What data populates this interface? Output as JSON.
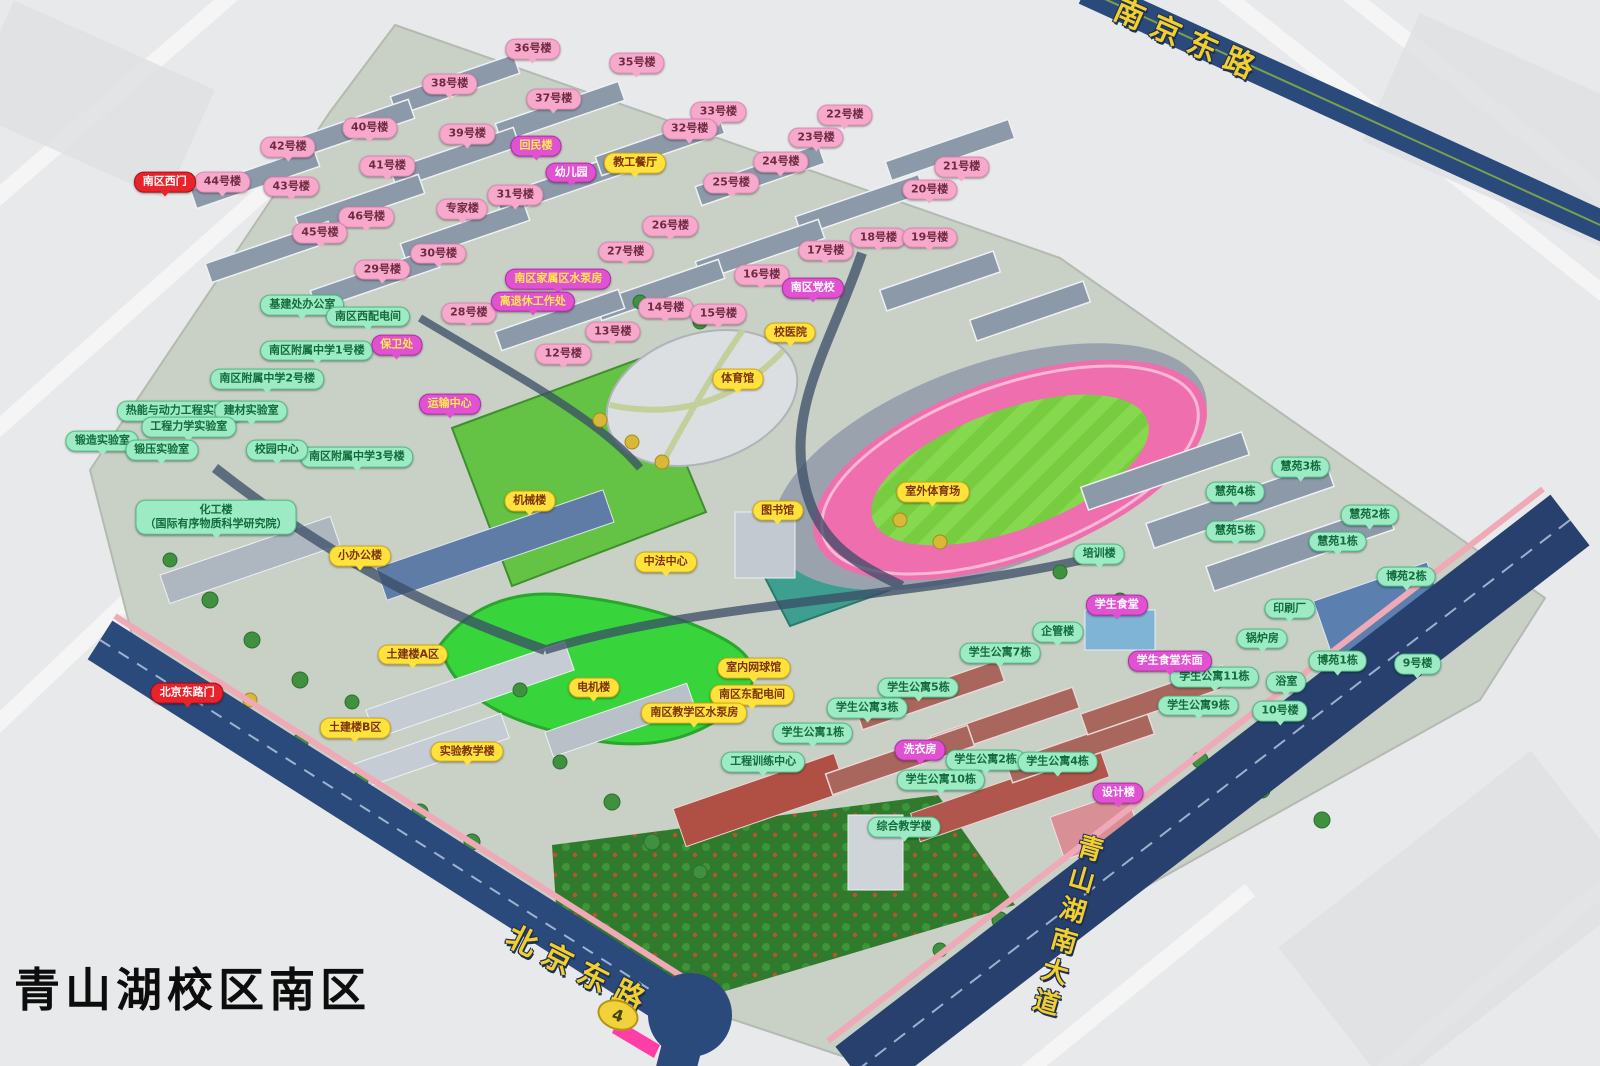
{
  "title": "青山湖校区南区",
  "route_badge": "4",
  "road_labels": [
    {
      "text": "南京东路",
      "x": 74.4,
      "y": 3.6,
      "rotate": 24,
      "vertical": false
    },
    {
      "text": "北京东路",
      "x": 36.3,
      "y": 90.8,
      "rotate": 27,
      "vertical": false
    },
    {
      "text": "青山湖南大道",
      "x": 66.6,
      "y": 87.0,
      "rotate": 16,
      "vertical": true
    }
  ],
  "colors": {
    "building_label_pink": "#F6A9CB",
    "facility_label_yellow": "#FFE23C",
    "facility_label_green": "#9CEBC4",
    "facility_label_magenta": "#E052D2",
    "gate_label_red": "#E8232B",
    "road": "#2B4A7C",
    "stadium_track": "#EF6FAE",
    "field_green": "#7FD84A"
  },
  "labels": [
    {
      "text": "36号楼",
      "x": 33.3,
      "y": 4.6,
      "type": "pink"
    },
    {
      "text": "35号楼",
      "x": 39.8,
      "y": 5.9,
      "type": "pink"
    },
    {
      "text": "38号楼",
      "x": 28.1,
      "y": 7.9,
      "type": "pink"
    },
    {
      "text": "37号楼",
      "x": 34.6,
      "y": 9.3,
      "type": "pink"
    },
    {
      "text": "33号楼",
      "x": 44.9,
      "y": 10.5,
      "type": "pink"
    },
    {
      "text": "32号楼",
      "x": 43.1,
      "y": 12.1,
      "type": "pink"
    },
    {
      "text": "22号楼",
      "x": 52.8,
      "y": 10.8,
      "type": "pink"
    },
    {
      "text": "23号楼",
      "x": 51.0,
      "y": 12.9,
      "type": "pink"
    },
    {
      "text": "40号楼",
      "x": 23.1,
      "y": 12.0,
      "type": "pink"
    },
    {
      "text": "39号楼",
      "x": 29.2,
      "y": 12.6,
      "type": "pink"
    },
    {
      "text": "42号楼",
      "x": 18.0,
      "y": 13.8,
      "type": "pink"
    },
    {
      "text": "41号楼",
      "x": 24.2,
      "y": 15.6,
      "type": "pink"
    },
    {
      "text": "44号楼",
      "x": 13.9,
      "y": 17.1,
      "type": "pink"
    },
    {
      "text": "43号楼",
      "x": 18.2,
      "y": 17.5,
      "type": "pink"
    },
    {
      "text": "24号楼",
      "x": 48.8,
      "y": 15.2,
      "type": "pink"
    },
    {
      "text": "25号楼",
      "x": 45.7,
      "y": 17.2,
      "type": "pink"
    },
    {
      "text": "21号楼",
      "x": 60.1,
      "y": 15.7,
      "type": "pink"
    },
    {
      "text": "20号楼",
      "x": 58.1,
      "y": 17.8,
      "type": "pink"
    },
    {
      "text": "31号楼",
      "x": 32.2,
      "y": 18.3,
      "type": "pink"
    },
    {
      "text": "专家楼",
      "x": 28.9,
      "y": 19.6,
      "type": "pink"
    },
    {
      "text": "46号楼",
      "x": 22.9,
      "y": 20.4,
      "type": "pink"
    },
    {
      "text": "45号楼",
      "x": 20.0,
      "y": 21.9,
      "type": "pink"
    },
    {
      "text": "26号楼",
      "x": 41.9,
      "y": 21.2,
      "type": "pink"
    },
    {
      "text": "27号楼",
      "x": 39.1,
      "y": 23.6,
      "type": "pink"
    },
    {
      "text": "17号楼",
      "x": 51.6,
      "y": 23.5,
      "type": "pink"
    },
    {
      "text": "18号楼",
      "x": 54.9,
      "y": 22.3,
      "type": "pink"
    },
    {
      "text": "19号楼",
      "x": 58.1,
      "y": 22.3,
      "type": "pink"
    },
    {
      "text": "30号楼",
      "x": 27.4,
      "y": 23.8,
      "type": "pink"
    },
    {
      "text": "29号楼",
      "x": 23.9,
      "y": 25.3,
      "type": "pink"
    },
    {
      "text": "28号楼",
      "x": 29.3,
      "y": 29.4,
      "type": "pink"
    },
    {
      "text": "16号楼",
      "x": 47.6,
      "y": 25.8,
      "type": "pink"
    },
    {
      "text": "14号楼",
      "x": 41.6,
      "y": 28.9,
      "type": "pink"
    },
    {
      "text": "15号楼",
      "x": 44.9,
      "y": 29.5,
      "type": "pink"
    },
    {
      "text": "13号楼",
      "x": 38.3,
      "y": 31.1,
      "type": "pink"
    },
    {
      "text": "12号楼",
      "x": 35.2,
      "y": 33.2,
      "type": "pink"
    },
    {
      "text": "教工餐厅",
      "x": 39.7,
      "y": 15.3,
      "type": "yellow"
    },
    {
      "text": "校医院",
      "x": 49.4,
      "y": 31.2,
      "type": "yellow"
    },
    {
      "text": "体育馆",
      "x": 46.1,
      "y": 35.6,
      "type": "yellow"
    },
    {
      "text": "室外体育场",
      "x": 58.3,
      "y": 46.2,
      "type": "yellow"
    },
    {
      "text": "机械楼",
      "x": 33.1,
      "y": 47.0,
      "type": "yellow"
    },
    {
      "text": "图书馆",
      "x": 48.6,
      "y": 47.9,
      "type": "yellow"
    },
    {
      "text": "中法中心",
      "x": 41.6,
      "y": 52.7,
      "type": "yellow"
    },
    {
      "text": "小办公楼",
      "x": 22.5,
      "y": 52.2,
      "type": "yellow"
    },
    {
      "text": "土建楼A区",
      "x": 25.8,
      "y": 61.4,
      "type": "yellow"
    },
    {
      "text": "土建楼B区",
      "x": 22.2,
      "y": 68.3,
      "type": "yellow"
    },
    {
      "text": "电机楼",
      "x": 37.1,
      "y": 64.5,
      "type": "yellow"
    },
    {
      "text": "实验教学楼",
      "x": 29.2,
      "y": 70.5,
      "type": "yellow"
    },
    {
      "text": "室内网球馆",
      "x": 47.1,
      "y": 62.7,
      "type": "yellow"
    },
    {
      "text": "南区东配电间",
      "x": 47.0,
      "y": 65.2,
      "type": "yellow"
    },
    {
      "text": "南区教学区水泵房",
      "x": 43.4,
      "y": 66.9,
      "type": "yellow"
    },
    {
      "text": "基建处办公室",
      "x": 18.9,
      "y": 28.6,
      "type": "green"
    },
    {
      "text": "南区西配电间",
      "x": 23.0,
      "y": 29.7,
      "type": "green"
    },
    {
      "text": "南区附属中学1号楼",
      "x": 19.8,
      "y": 32.9,
      "type": "green"
    },
    {
      "text": "南区附属中学2号楼",
      "x": 16.7,
      "y": 35.6,
      "type": "green"
    },
    {
      "text": "南区附属中学3号楼",
      "x": 22.3,
      "y": 42.9,
      "type": "green"
    },
    {
      "text": "热能与动力工程实验室",
      "x": 11.3,
      "y": 38.6,
      "type": "green"
    },
    {
      "text": "建材实验室",
      "x": 15.7,
      "y": 38.6,
      "type": "green"
    },
    {
      "text": "工程力学实验室",
      "x": 11.8,
      "y": 40.1,
      "type": "green"
    },
    {
      "text": "锻造实验室",
      "x": 6.4,
      "y": 41.4,
      "type": "green"
    },
    {
      "text": "锻压实验室",
      "x": 10.1,
      "y": 42.2,
      "type": "green"
    },
    {
      "text": "校园中心",
      "x": 17.3,
      "y": 42.2,
      "type": "green"
    },
    {
      "text": "化工楼\n（国际有序物质科学研究院）",
      "x": 13.5,
      "y": 48.5,
      "type": "green"
    },
    {
      "text": "慧苑3栋",
      "x": 81.3,
      "y": 43.8,
      "type": "green"
    },
    {
      "text": "慧苑4栋",
      "x": 77.2,
      "y": 46.2,
      "type": "green"
    },
    {
      "text": "慧苑2栋",
      "x": 85.6,
      "y": 48.3,
      "type": "green"
    },
    {
      "text": "慧苑5栋",
      "x": 77.2,
      "y": 49.8,
      "type": "green"
    },
    {
      "text": "慧苑1栋",
      "x": 83.6,
      "y": 50.8,
      "type": "green"
    },
    {
      "text": "博苑2栋",
      "x": 87.9,
      "y": 54.1,
      "type": "green"
    },
    {
      "text": "博苑1栋",
      "x": 83.6,
      "y": 62.0,
      "type": "green"
    },
    {
      "text": "培训楼",
      "x": 68.7,
      "y": 52.0,
      "type": "green"
    },
    {
      "text": "企管楼",
      "x": 66.1,
      "y": 59.3,
      "type": "green"
    },
    {
      "text": "印刷厂",
      "x": 80.6,
      "y": 57.1,
      "type": "green"
    },
    {
      "text": "锅炉房",
      "x": 78.9,
      "y": 59.9,
      "type": "green"
    },
    {
      "text": "9号楼",
      "x": 88.6,
      "y": 62.3,
      "type": "green"
    },
    {
      "text": "10号楼",
      "x": 80.0,
      "y": 66.7,
      "type": "green"
    },
    {
      "text": "浴室",
      "x": 80.4,
      "y": 64.0,
      "type": "green"
    },
    {
      "text": "学生公寓11栋",
      "x": 75.9,
      "y": 63.5,
      "type": "green"
    },
    {
      "text": "学生公寓9栋",
      "x": 74.9,
      "y": 66.2,
      "type": "green"
    },
    {
      "text": "学生公寓7栋",
      "x": 62.5,
      "y": 61.3,
      "type": "green"
    },
    {
      "text": "学生公寓5栋",
      "x": 57.4,
      "y": 64.5,
      "type": "green"
    },
    {
      "text": "学生公寓3栋",
      "x": 54.2,
      "y": 66.4,
      "type": "green"
    },
    {
      "text": "学生公寓1栋",
      "x": 50.8,
      "y": 68.8,
      "type": "green"
    },
    {
      "text": "学生公寓2栋",
      "x": 61.6,
      "y": 71.3,
      "type": "green"
    },
    {
      "text": "学生公寓4栋",
      "x": 66.1,
      "y": 71.5,
      "type": "green"
    },
    {
      "text": "学生公寓10栋",
      "x": 58.8,
      "y": 73.2,
      "type": "green"
    },
    {
      "text": "工程训练中心",
      "x": 47.7,
      "y": 71.5,
      "type": "green"
    },
    {
      "text": "综合教学楼",
      "x": 56.5,
      "y": 77.6,
      "type": "green"
    },
    {
      "text": "幼儿园",
      "x": 35.7,
      "y": 16.2,
      "type": "magenta"
    },
    {
      "text": "南区党校",
      "x": 50.8,
      "y": 27.0,
      "type": "magenta"
    },
    {
      "text": "学生食堂",
      "x": 69.8,
      "y": 56.8,
      "type": "magenta"
    },
    {
      "text": "学生食堂东面",
      "x": 73.1,
      "y": 62.0,
      "type": "magenta"
    },
    {
      "text": "洗衣房",
      "x": 57.5,
      "y": 70.4,
      "type": "magenta"
    },
    {
      "text": "设计楼",
      "x": 69.9,
      "y": 74.4,
      "type": "magenta"
    },
    {
      "text": "回民楼",
      "x": 33.5,
      "y": 13.7,
      "type": "magentaY"
    },
    {
      "text": "南区家属区水泵房",
      "x": 34.9,
      "y": 26.2,
      "type": "magentaY"
    },
    {
      "text": "离退休工作处",
      "x": 33.3,
      "y": 28.3,
      "type": "magentaY"
    },
    {
      "text": "保卫处",
      "x": 24.8,
      "y": 32.4,
      "type": "magentaY"
    },
    {
      "text": "运输中心",
      "x": 28.1,
      "y": 37.9,
      "type": "magentaY"
    },
    {
      "text": "南区西门",
      "x": 10.3,
      "y": 17.1,
      "type": "red"
    },
    {
      "text": "北京东路门",
      "x": 11.7,
      "y": 65.0,
      "type": "red"
    }
  ]
}
